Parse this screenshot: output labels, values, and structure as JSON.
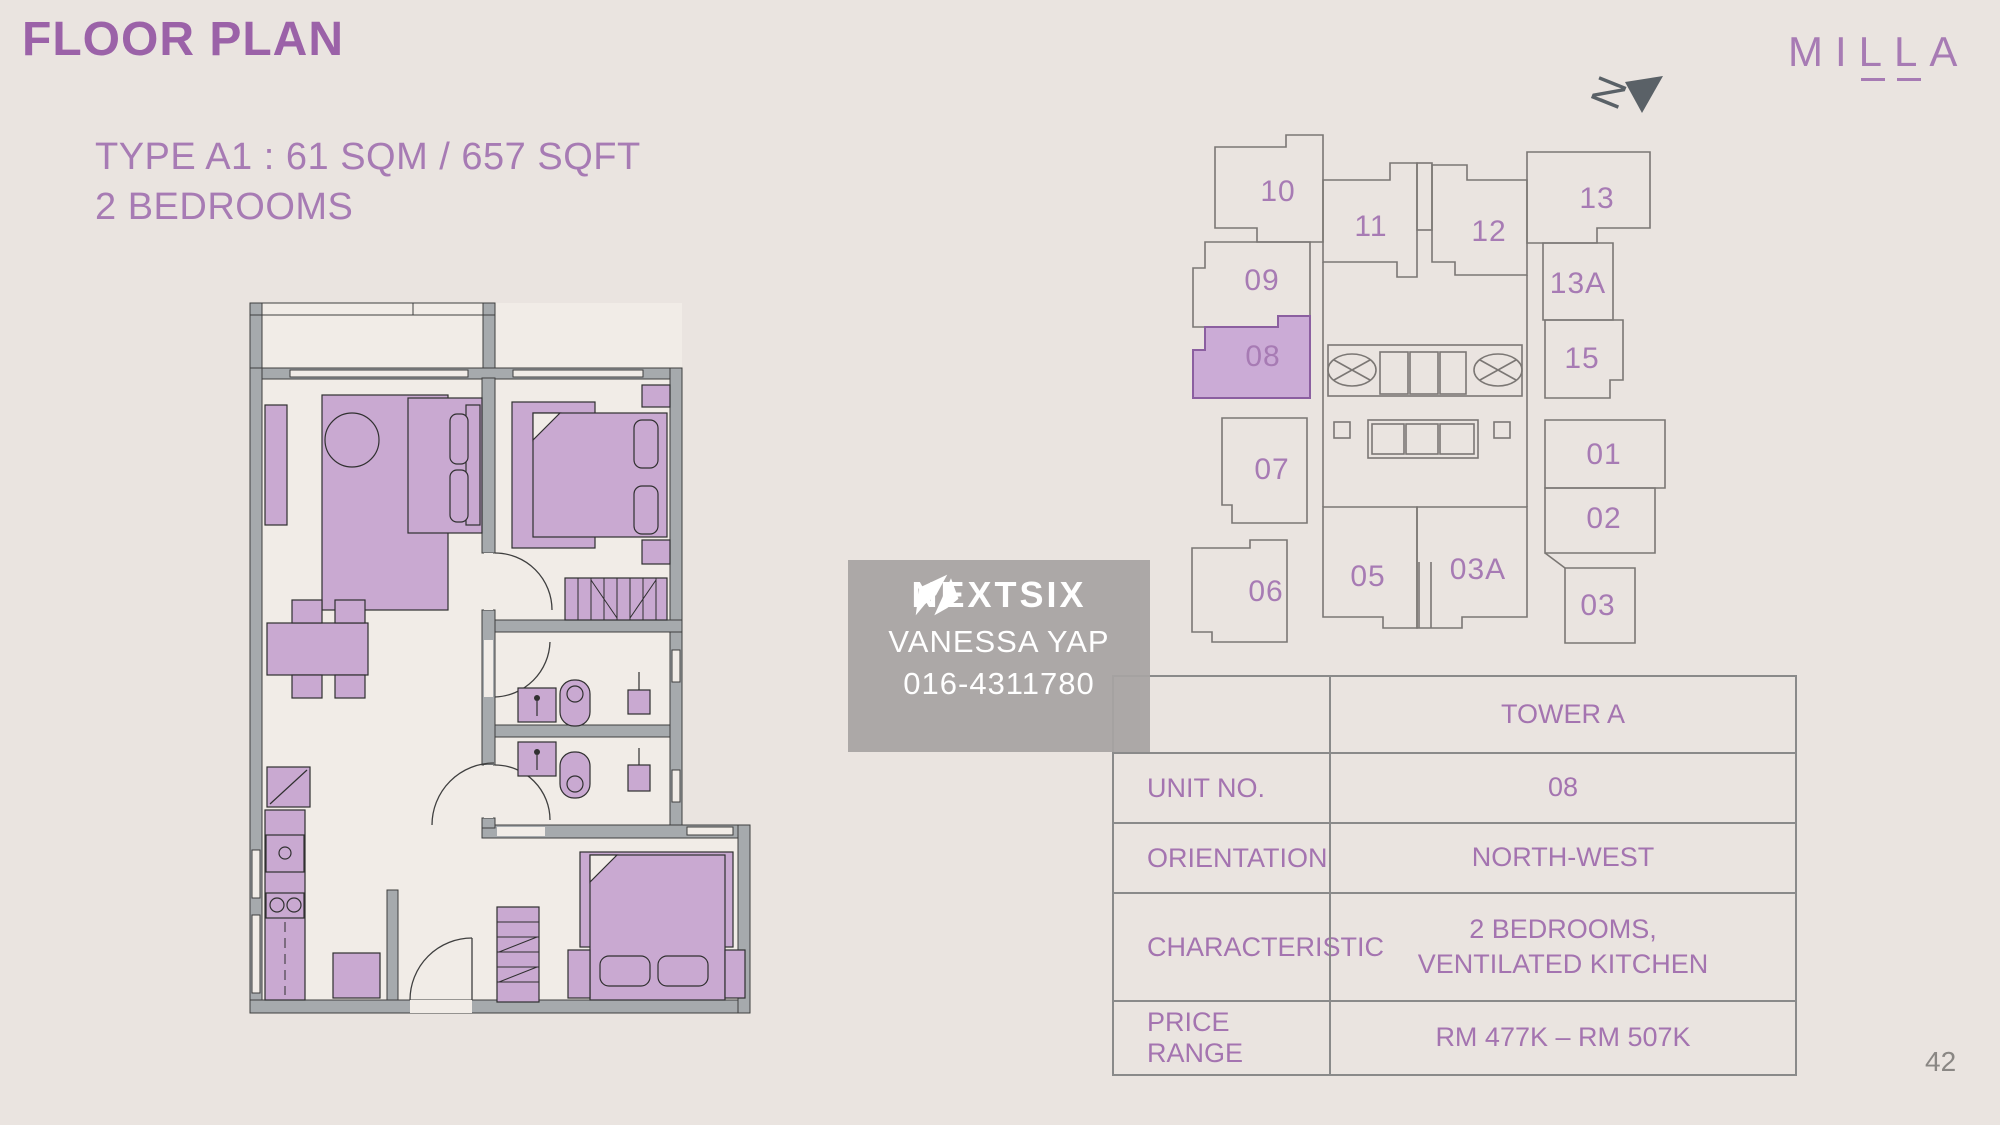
{
  "page": {
    "background_color": "#EAE4E0"
  },
  "header": {
    "title": "FLOOR PLAN",
    "type_line": "TYPE A1 : 61 SQM / 657 SQFT",
    "bedrooms_line": "2 BEDROOMS",
    "title_color": "#9B62A8",
    "accent_color": "#A77BB4"
  },
  "brand": {
    "logo_text": "MILLA",
    "color": "#A77BB4"
  },
  "north_indicator": {
    "letter": "N",
    "color": "#5A6167"
  },
  "key_plan": {
    "highlighted_unit": "08",
    "highlight_fill": "#CBABD6",
    "highlight_stroke": "#8B5FA0",
    "outline_color": "#7B7774",
    "label_color": "#A77BB4",
    "units": [
      {
        "label": "10",
        "x": 1278,
        "y": 192,
        "highlighted": false
      },
      {
        "label": "11",
        "x": 1371,
        "y": 227,
        "highlighted": false
      },
      {
        "label": "12",
        "x": 1489,
        "y": 232,
        "highlighted": false
      },
      {
        "label": "13",
        "x": 1597,
        "y": 199,
        "highlighted": false
      },
      {
        "label": "09",
        "x": 1262,
        "y": 281,
        "highlighted": false
      },
      {
        "label": "13A",
        "x": 1578,
        "y": 284,
        "highlighted": false
      },
      {
        "label": "08",
        "x": 1263,
        "y": 357,
        "highlighted": true
      },
      {
        "label": "15",
        "x": 1582,
        "y": 359,
        "highlighted": false
      },
      {
        "label": "07",
        "x": 1272,
        "y": 470,
        "highlighted": false
      },
      {
        "label": "01",
        "x": 1604,
        "y": 455,
        "highlighted": false
      },
      {
        "label": "02",
        "x": 1604,
        "y": 519,
        "highlighted": false
      },
      {
        "label": "06",
        "x": 1266,
        "y": 592,
        "highlighted": false
      },
      {
        "label": "05",
        "x": 1368,
        "y": 577,
        "highlighted": false
      },
      {
        "label": "03A",
        "x": 1478,
        "y": 570,
        "highlighted": false
      },
      {
        "label": "03",
        "x": 1598,
        "y": 606,
        "highlighted": false
      }
    ]
  },
  "watermark": {
    "agency": "NEXTSIX",
    "agent_name": "VANESSA YAP",
    "agent_phone": "016-4311780",
    "box_color": "#A7A4A2",
    "text_color": "#FFFFFF"
  },
  "info_table": {
    "border_color": "#8A8A8A",
    "text_color": "#A474B0",
    "rows": [
      {
        "label": "",
        "value": "TOWER A"
      },
      {
        "label": "UNIT NO.",
        "value": "08"
      },
      {
        "label": "ORIENTATION",
        "value": "NORTH-WEST"
      },
      {
        "label": "CHARACTERISTIC",
        "value": "2 BEDROOMS,\nVENTILATED KITCHEN"
      },
      {
        "label": "PRICE RANGE",
        "value": "RM 477K – RM 507K"
      }
    ]
  },
  "floor_plan": {
    "wall_color": "#A6AAAD",
    "furniture_color": "#C9A9D1",
    "floor_color": "#F1ECE7",
    "line_color": "#3F3F3F"
  },
  "footer": {
    "page_number": "42"
  }
}
